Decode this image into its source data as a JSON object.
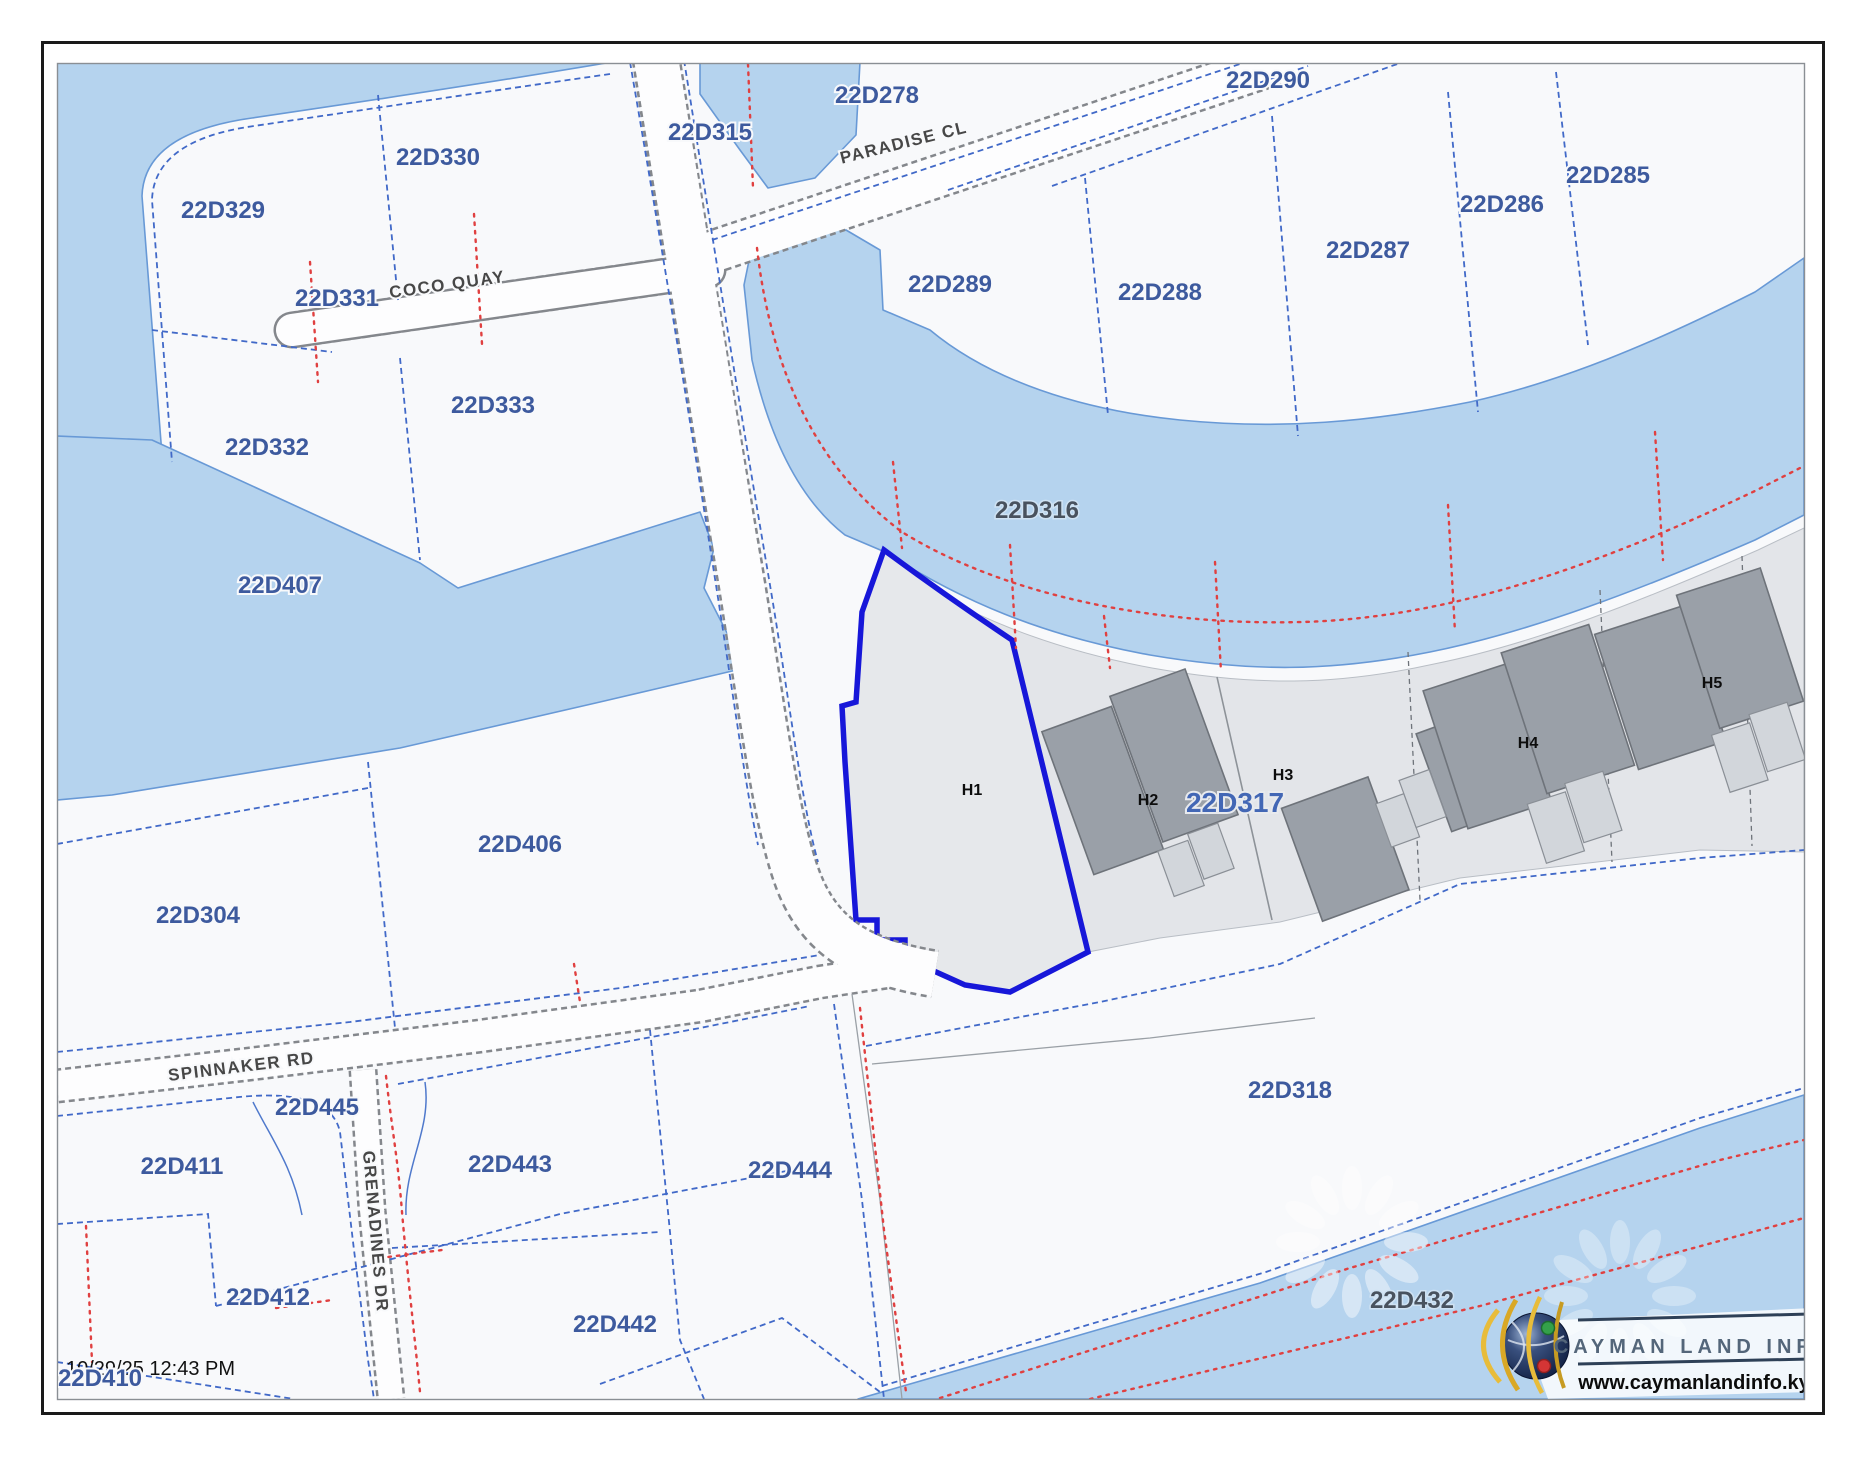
{
  "app": {
    "timestamp": "10/29/25 12:43 PM"
  },
  "branding": {
    "org": "CAYMAN LAND INFO",
    "website": "www.caymanlandinfo.ky"
  },
  "colors": {
    "water_fill": "#b5d3ee",
    "water_edge": "#6899d6",
    "land_fill": "#f8f9fb",
    "parcel_boundary_blue": "#4169c8",
    "survey_line_red": "#e04040",
    "road_casing_gray": "#84878c",
    "selected_parcel_outline": "#1717d9",
    "parcel_band_fill": "#e3e5e9",
    "building_fill": "#9aa0a8",
    "building_annex_fill": "#d2d6db",
    "parcel_label": "#3d5a9e",
    "water_parcel_label": "#49525e",
    "highlight_parcel_label": "#4367b5",
    "road_label": "#474747",
    "house_label": "#0d0d0d"
  },
  "map": {
    "labels": [
      {
        "text": "22D329",
        "x": 223,
        "y": 218,
        "kind": "parcel"
      },
      {
        "text": "22D330",
        "x": 438,
        "y": 165,
        "kind": "parcel"
      },
      {
        "text": "22D315",
        "x": 710,
        "y": 140,
        "kind": "parcel"
      },
      {
        "text": "22D278",
        "x": 877,
        "y": 103,
        "kind": "parcel"
      },
      {
        "text": "22D290",
        "x": 1268,
        "y": 88,
        "kind": "parcel"
      },
      {
        "text": "22D285",
        "x": 1608,
        "y": 183,
        "kind": "parcel"
      },
      {
        "text": "22D286",
        "x": 1502,
        "y": 212,
        "kind": "parcel"
      },
      {
        "text": "22D287",
        "x": 1368,
        "y": 258,
        "kind": "parcel"
      },
      {
        "text": "22D288",
        "x": 1160,
        "y": 300,
        "kind": "parcel"
      },
      {
        "text": "22D289",
        "x": 950,
        "y": 292,
        "kind": "parcel"
      },
      {
        "text": "22D331",
        "x": 337,
        "y": 306,
        "kind": "parcel"
      },
      {
        "text": "22D333",
        "x": 493,
        "y": 413,
        "kind": "parcel"
      },
      {
        "text": "22D332",
        "x": 267,
        "y": 455,
        "kind": "parcel"
      },
      {
        "text": "22D407",
        "x": 280,
        "y": 593,
        "kind": "parcel"
      },
      {
        "text": "22D316",
        "x": 1037,
        "y": 518,
        "kind": "water"
      },
      {
        "text": "22D406",
        "x": 520,
        "y": 852,
        "kind": "parcel"
      },
      {
        "text": "22D304",
        "x": 198,
        "y": 923,
        "kind": "parcel"
      },
      {
        "text": "22D317",
        "x": 1235,
        "y": 812,
        "kind": "focus"
      },
      {
        "text": "22D318",
        "x": 1290,
        "y": 1098,
        "kind": "parcel"
      },
      {
        "text": "22D445",
        "x": 317,
        "y": 1115,
        "kind": "parcel"
      },
      {
        "text": "22D411",
        "x": 182,
        "y": 1174,
        "kind": "parcel"
      },
      {
        "text": "22D443",
        "x": 510,
        "y": 1172,
        "kind": "parcel"
      },
      {
        "text": "22D444",
        "x": 790,
        "y": 1178,
        "kind": "parcel"
      },
      {
        "text": "22D412",
        "x": 268,
        "y": 1305,
        "kind": "parcel"
      },
      {
        "text": "22D442",
        "x": 615,
        "y": 1332,
        "kind": "parcel"
      },
      {
        "text": "22D410",
        "x": 100,
        "y": 1386,
        "kind": "parcel"
      },
      {
        "text": "22D432",
        "x": 1412,
        "y": 1308,
        "kind": "water"
      },
      {
        "text": "H1",
        "x": 972,
        "y": 795,
        "kind": "house"
      },
      {
        "text": "H2",
        "x": 1148,
        "y": 805,
        "kind": "house"
      },
      {
        "text": "H3",
        "x": 1283,
        "y": 780,
        "kind": "house"
      },
      {
        "text": "H4",
        "x": 1528,
        "y": 748,
        "kind": "house"
      },
      {
        "text": "H5",
        "x": 1712,
        "y": 688,
        "kind": "house"
      },
      {
        "text": "PARADISE CL",
        "x": 905,
        "y": 148,
        "rot": -14,
        "kind": "road"
      },
      {
        "text": "COCO QUAY",
        "x": 448,
        "y": 290,
        "rot": -8,
        "kind": "road"
      },
      {
        "text": "SPINNAKER RD",
        "x": 242,
        "y": 1072,
        "rot": -7,
        "kind": "road"
      },
      {
        "text": "GRENADINES DR",
        "x": 370,
        "y": 1232,
        "rot": 85,
        "kind": "road"
      }
    ]
  }
}
